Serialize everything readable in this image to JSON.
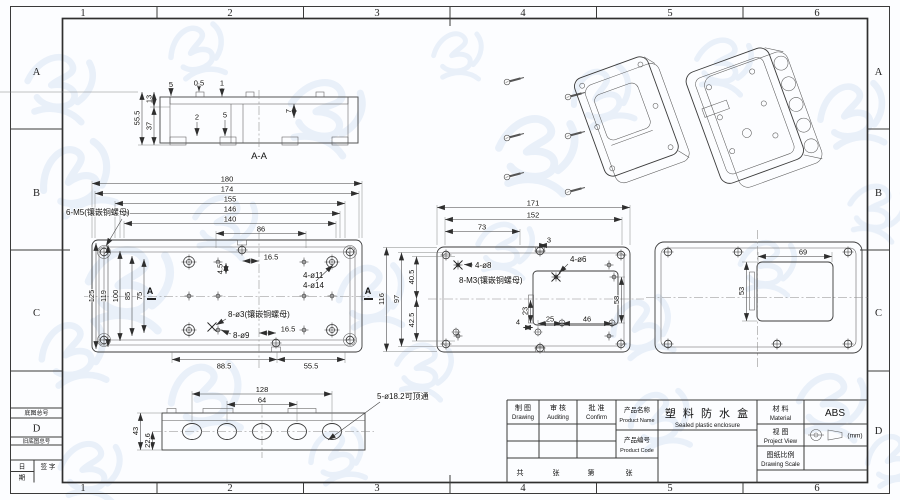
{
  "sheet": {
    "cols": [
      "1",
      "2",
      "3",
      "4",
      "5",
      "6"
    ],
    "rows": [
      "A",
      "B",
      "C",
      "D"
    ],
    "corner": {
      "base_no": "底图总号",
      "row_d": "D",
      "old_base_no": "旧底图总号",
      "date_top": "日",
      "date_bottom": "期",
      "signature": "签 字"
    }
  },
  "section": {
    "label": "A-A",
    "total_h": "55.5",
    "inner_h": "37",
    "top_h": "13",
    "t_a": "5",
    "t_b": "0.5",
    "t_c": "1",
    "t_d": "2",
    "t_e": "5",
    "t_f": "7"
  },
  "front": {
    "w_180": "180",
    "w_174": "174",
    "w_155": "155",
    "w_146": "146",
    "w_140": "140",
    "w_86": "86",
    "off_top": "16.5",
    "off_bottom": "16.5",
    "h_125": "125",
    "h_119": "119",
    "h_100": "100",
    "h_85": "85",
    "h_75": "75",
    "b_885": "88.5",
    "b_555": "55.5",
    "d_45": "4.5",
    "note_m5": "6-M5(镶嵌铜螺母)",
    "note_d11": "4-ø11",
    "note_d14": "4-ø14",
    "note_d3": "8-ø3(镶嵌铜螺母)",
    "note_d9": "8-ø9",
    "sec_left": "A",
    "sec_right": "A"
  },
  "middle": {
    "w_171": "171",
    "w_152": "152",
    "w_73": "73",
    "d_3": "3",
    "h_116": "116",
    "h_97": "97",
    "h_405": "40.5",
    "h_425": "42.5",
    "i_25": "25",
    "i_46": "46",
    "i_58": "58",
    "i_23": "23",
    "i_4": "4",
    "note_d8": "4-ø8",
    "note_m3": "8-M3(镶嵌铜螺母)",
    "note_d6": "4-ø6"
  },
  "side": {
    "w_69": "69",
    "h_53": "53"
  },
  "bottom": {
    "w_128": "128",
    "w_64": "64",
    "h_43": "43",
    "h_226": "22.6",
    "note": "5-ø18.2可顶通"
  },
  "title_block": {
    "drawing": {
      "zh": "制 图",
      "en": "Drawing"
    },
    "auditing": {
      "zh": "审 核",
      "en": "Auditing"
    },
    "confirm": {
      "zh": "批 准",
      "en": "Confirm"
    },
    "product_name_label": {
      "zh": "产品名称",
      "en": "Product Name"
    },
    "product_name": {
      "zh": "塑 料 防 水 盒",
      "en": "Sealed plastic enclosure"
    },
    "product_code_label": {
      "zh": "产品编号",
      "en": "Product Code"
    },
    "material": {
      "zh": "材 料",
      "en": "Material",
      "value": "ABS"
    },
    "view": {
      "zh": "视 图",
      "en": "Project View",
      "unit": "(mm)"
    },
    "scale": {
      "zh": "图纸比例",
      "en": "Drawing Scale"
    },
    "sheets": {
      "total_label": "共",
      "total_unit": "张",
      "no_label": "第",
      "no_unit": "张"
    }
  }
}
